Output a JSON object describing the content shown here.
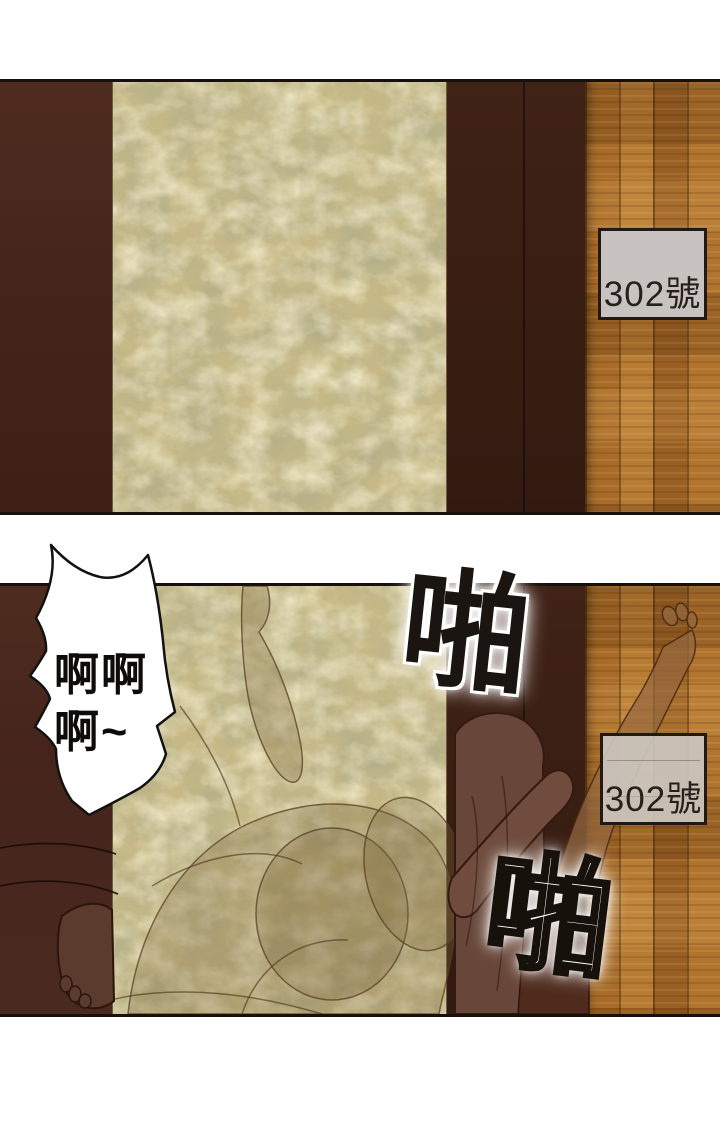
{
  "page": {
    "kind": "comic-page",
    "panel_count": 2
  },
  "panel1": {
    "room_sign": "302號"
  },
  "panel2": {
    "room_sign": "302號",
    "bubble_line1": "啊啊",
    "bubble_line2": "啊~",
    "sfx1": "啪",
    "sfx2": "啪"
  },
  "colors": {
    "outline": "#17100b",
    "door_frame_dark": "#45241b",
    "door_panel_gold": "#c6b987",
    "floor_wood": "#aa6e29",
    "sign_background": "#c8c2c0",
    "sign_text": "#261f1a",
    "silhouette_brown": "#684639",
    "bubble_fill": "#ffffff"
  }
}
